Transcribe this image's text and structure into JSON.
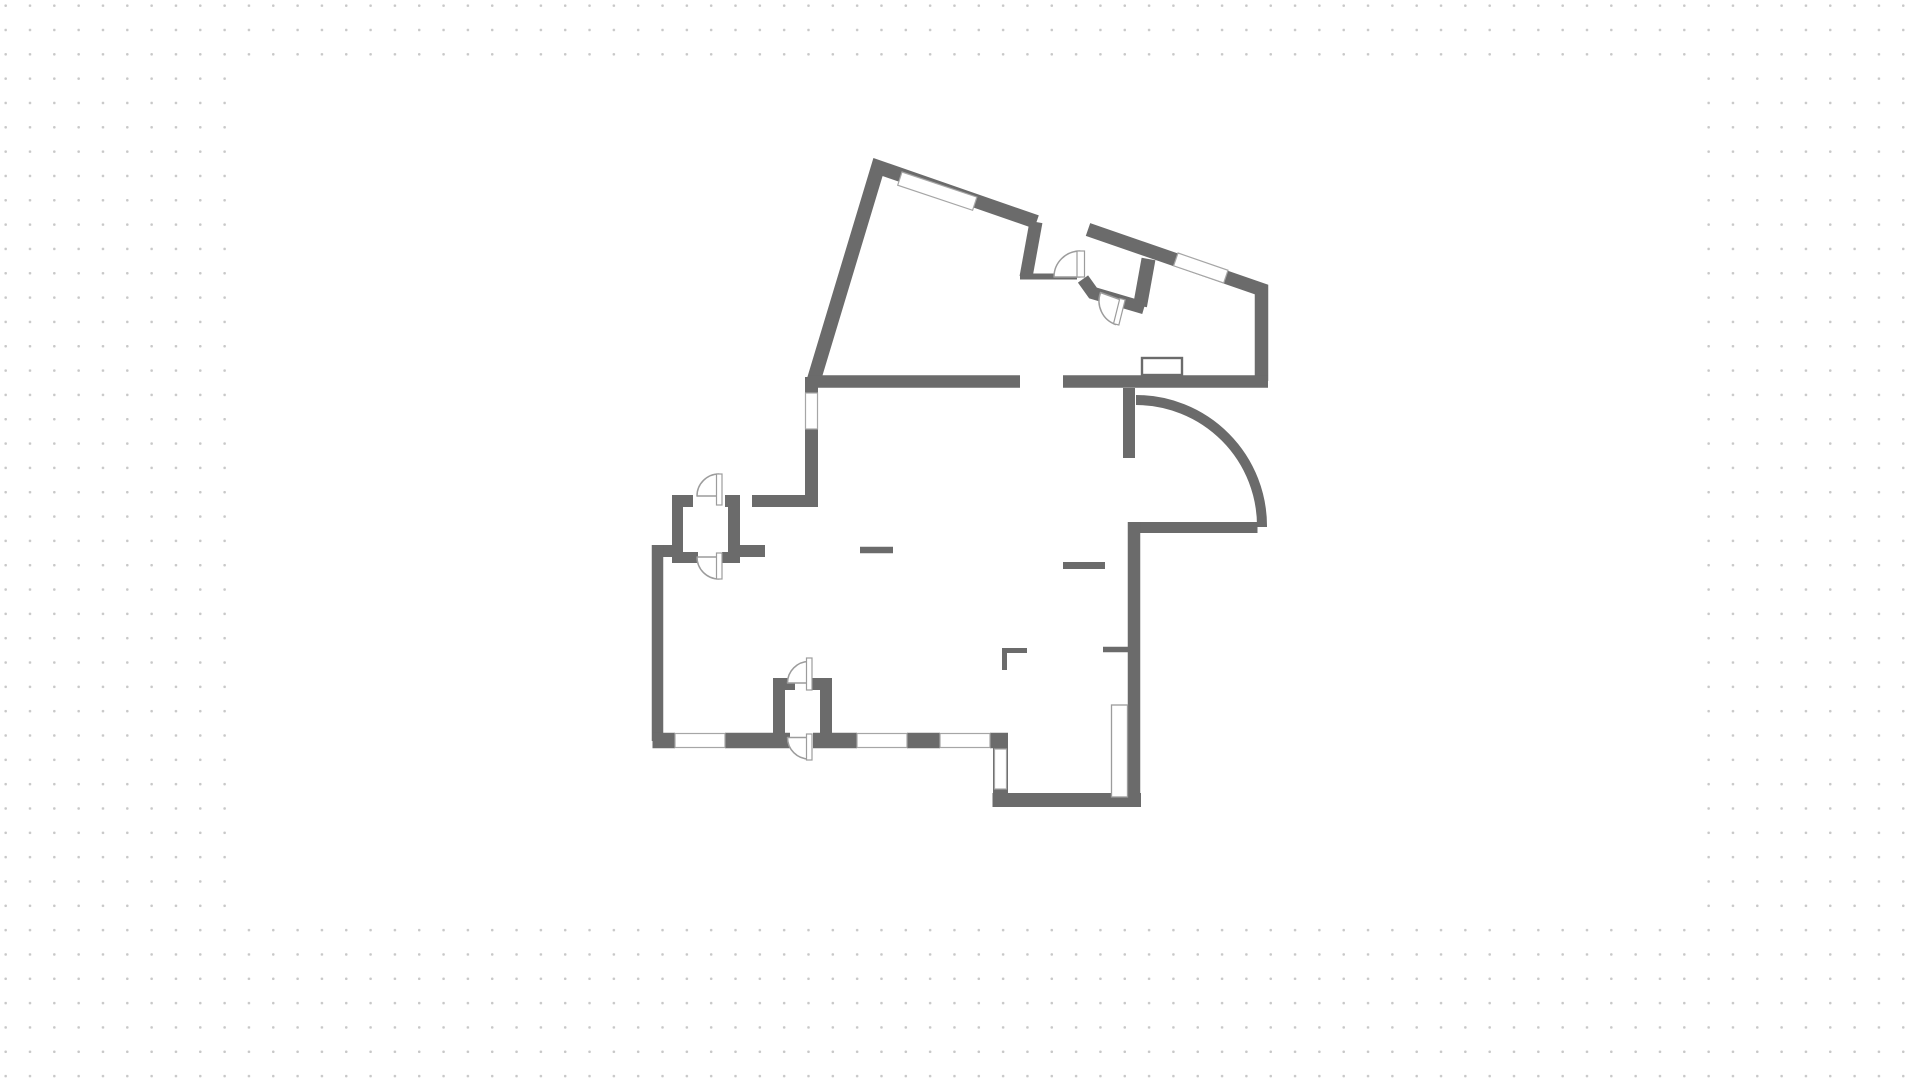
{
  "workspace": {
    "dot_color": "#c8c8c8",
    "background": "#ffffff",
    "canvas": {
      "x": 226,
      "y": 66,
      "width": 1466,
      "height": 846,
      "fill": "#ffffff"
    }
  },
  "floorplan": {
    "colors": {
      "wall": "#6b6b6b",
      "symbol_outline": "#9c9c9c",
      "window_outline": "#a6a6a6",
      "fill": "#ffffff"
    },
    "walls": [
      {
        "name": "outer-wall-top-left",
        "d": "M813.5,381 L878,167 L1036.5,222",
        "w": 14
      },
      {
        "name": "wall-toproom-right",
        "d": "M1036,222 L1026,277",
        "w": 13
      },
      {
        "name": "wall-hall-thin",
        "d": "M1020,276.5 L1077,276.5",
        "w": 6
      },
      {
        "name": "outer-wall-vestibule-top-right",
        "d": "M1088,229.5 L1261.5,289.5 L1261.5,381",
        "w": 13.5
      },
      {
        "name": "wall-vestibule-inner-right",
        "d": "M1148.5,259 L1140,306",
        "w": 14
      },
      {
        "name": "wall-vestibule-bottom-left",
        "d": "M1083,279 L1093,293 L1144,308",
        "w": 12.5
      },
      {
        "name": "wall-mid-horizontal-left",
        "d": "M808,381.5 L1020,381.5",
        "w": 12.5
      },
      {
        "name": "wall-mid-horizontal-right",
        "d": "M1063,381.5 L1268,381.5",
        "w": 12.5
      },
      {
        "name": "wall-stub-below-mid",
        "d": "M1129,388 L1129,458",
        "w": 12
      },
      {
        "name": "wall-lower-right-horizontal",
        "d": "M1139,527.5 L1257.5,527.5",
        "w": 11
      },
      {
        "name": "outer-wall-right-lower",
        "d": "M1134,522 L1134,806",
        "w": 12.5
      },
      {
        "name": "outer-wall-bottomright-bottom",
        "d": "M1141,800 L992.5,800",
        "w": 14
      },
      {
        "name": "outer-wall-bottomright-left",
        "d": "M1000.5,733 L1000.5,806",
        "w": 15
      },
      {
        "name": "outer-wall-upper-left-vertical",
        "d": "M811.5,377 L811.5,507",
        "w": 13
      },
      {
        "name": "wall-closet-top-a",
        "d": "M672,501 L693,501",
        "w": 12
      },
      {
        "name": "wall-closet-top-b",
        "d": "M725,501 L740,501",
        "w": 12
      },
      {
        "name": "wall-closet-top-c",
        "d": "M752,501 L818,501",
        "w": 12
      },
      {
        "name": "wall-closet-left",
        "d": "M677.5,495 L677.5,563",
        "w": 11
      },
      {
        "name": "wall-closet-right",
        "d": "M734,495 L734,563",
        "w": 12
      },
      {
        "name": "wall-closet-bottom-a",
        "d": "M672,557.5 L698,557.5",
        "w": 11
      },
      {
        "name": "wall-closet-bottom-b",
        "d": "M722,557.5 L740,557.5",
        "w": 11
      },
      {
        "name": "wall-step-stub-left",
        "d": "M652,551 L683,551",
        "w": 12
      },
      {
        "name": "wall-stub-right-of-closet",
        "d": "M740,551 L765,551",
        "w": 12
      },
      {
        "name": "outer-wall-left-lower",
        "d": "M657.5,545 L657.5,741",
        "w": 11.5
      },
      {
        "name": "outer-wall-bottom-dash-a",
        "d": "M652.5,740.5 L675,740.5",
        "w": 15.5
      },
      {
        "name": "outer-wall-bottom-dash-b",
        "d": "M725,740.5 L790,740.5",
        "w": 15.5
      },
      {
        "name": "outer-wall-bottom-dash-c",
        "d": "M813,740.5 L857,740.5",
        "w": 15.5
      },
      {
        "name": "outer-wall-bottom-dash-d",
        "d": "M907,740.5 L940,740.5",
        "w": 15.5
      },
      {
        "name": "outer-wall-bottom-corner-block",
        "d": "M990,740.5 L1008,740.5",
        "w": 15.5
      },
      {
        "name": "wall-alcove-left-vertical",
        "d": "M779,680 L779,736",
        "w": 12
      },
      {
        "name": "wall-alcove-left-stub",
        "d": "M773,684 L795,684",
        "w": 12
      },
      {
        "name": "wall-alcove-right-vertical",
        "d": "M826,680 L826,736",
        "w": 12
      },
      {
        "name": "wall-alcove-right-stub",
        "d": "M808,684 L832,684",
        "w": 12
      },
      {
        "name": "interior-dash-1",
        "d": "M860,550 L893,550",
        "w": 6.5
      },
      {
        "name": "interior-dash-2",
        "d": "M1063,565.5 L1105,565.5",
        "w": 7
      },
      {
        "name": "interior-stub-bottomright",
        "d": "M1103,649.5 L1128,649.5",
        "w": 5.5
      },
      {
        "name": "interior-corner-mark-h",
        "d": "M1002,650.5 L1027,650.5",
        "w": 5
      },
      {
        "name": "interior-corner-mark-v",
        "d": "M1004.5,648 L1004.5,670",
        "w": 5
      }
    ],
    "arcs": [
      {
        "name": "large-curved-opening-arc",
        "d": "M1136,400 A126,126 0 0 1 1262,527",
        "w": 10
      }
    ],
    "windows": [
      {
        "name": "window-top-left-wall",
        "type": "polygon",
        "points": "902,172 976.9,197.1 972.6,210.3 897.7,185.2"
      },
      {
        "name": "window-vestibule-wall",
        "type": "polygon",
        "points": "1178,253 1228,270.3 1223.7,283 1173.6,265.8"
      },
      {
        "name": "window-upper-left-vertical",
        "type": "rect",
        "x": 805.5,
        "y": 393,
        "w": 12,
        "h": 36
      },
      {
        "name": "window-bottom-wall-1",
        "type": "rect",
        "x": 675,
        "y": 733.5,
        "w": 50,
        "h": 14
      },
      {
        "name": "window-bottom-wall-2",
        "type": "rect",
        "x": 857,
        "y": 733.5,
        "w": 50,
        "h": 14
      },
      {
        "name": "window-bottom-wall-3",
        "type": "rect",
        "x": 940,
        "y": 733.5,
        "w": 50,
        "h": 14
      },
      {
        "name": "window-bottomright-left-wall",
        "type": "rect",
        "x": 994.5,
        "y": 749,
        "w": 12,
        "h": 40
      }
    ],
    "frames": [
      {
        "name": "wall-niche-frame",
        "x": 1142,
        "y": 358,
        "w": 40,
        "h": 17,
        "stroke": "#6b6b6b",
        "sw": 2.4
      },
      {
        "name": "open-door-leaf-bottomright",
        "x": 1111.5,
        "y": 705,
        "w": 16,
        "h": 92,
        "stroke": "#9c9c9c",
        "sw": 1.3
      }
    ],
    "doors": [
      {
        "name": "door-vestibule-left",
        "pie": "M1080,277 L1054,277 A26,26 0 0 1 1080,251 Z",
        "leaf": {
          "x": 1077,
          "y": 251,
          "w": 7.5,
          "h": 26
        }
      },
      {
        "name": "door-vestibule-bottom",
        "pie": "M1124,301 L1100.5,292.5 A25,25 0 0 0 1115.5,324.5 Z",
        "leaf": {
          "x": 1119.5,
          "y": 299,
          "w": 5.5,
          "h": 26,
          "transform": "rotate(14 1122 300)"
        }
      },
      {
        "name": "door-closet-top",
        "pie": "M719,496 L697,496 A22,22 0 0 1 719,474 Z",
        "leaf": {
          "x": 716.5,
          "y": 474,
          "w": 5.5,
          "h": 31
        }
      },
      {
        "name": "door-closet-bottom",
        "pie": "M719,557 L697,557 A22,22 0 0 0 719,579 Z",
        "leaf": {
          "x": 716.5,
          "y": 553,
          "w": 5.5,
          "h": 26
        }
      },
      {
        "name": "door-alcove-top",
        "pie": "M809,683 L787.5,683 A21.5,21.5 0 0 1 809,661.5 Z",
        "leaf": {
          "x": 806.5,
          "y": 658,
          "w": 5.5,
          "h": 32
        }
      },
      {
        "name": "door-entry-bottom",
        "pie": "M809,737.5 L787.5,737.5 A21.5,21.5 0 0 0 809,759 Z",
        "leaf": {
          "x": 806.5,
          "y": 734,
          "w": 5.5,
          "h": 26
        }
      }
    ]
  }
}
